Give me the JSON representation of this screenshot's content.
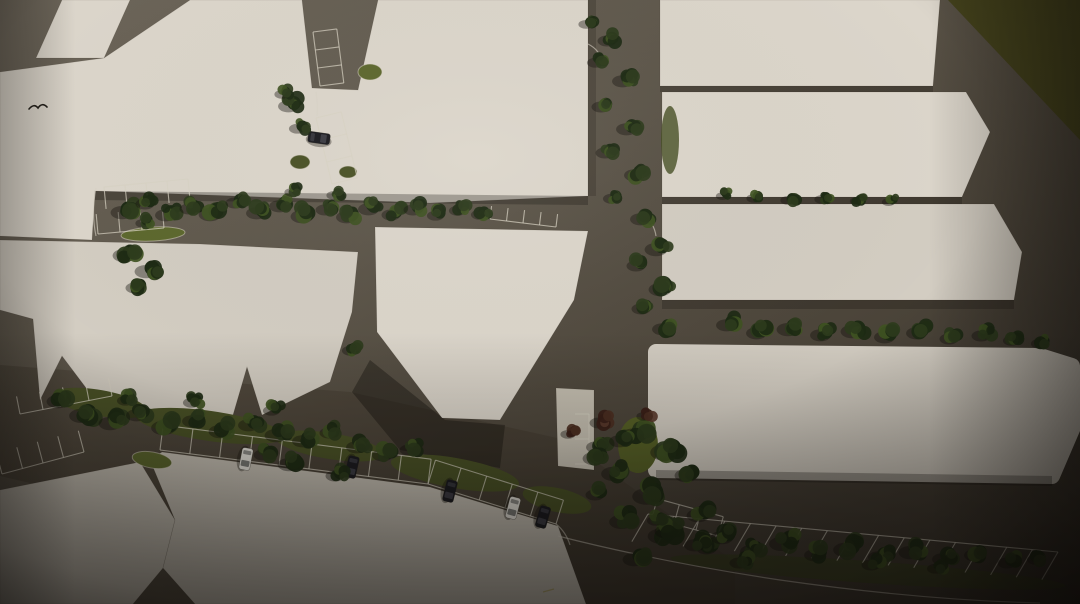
{
  "scene": {
    "description": "Aerial top-down architectural site-plan rendering: cream building blocks separated by dark asphalt roads, street trees, striped parking bays, a few parked cars, olive grass corner at top right, photographic vignette",
    "canvas": {
      "width": 1080,
      "height": 604
    },
    "palette": {
      "road_light": "#6e675b",
      "road_mid": "#5a5348",
      "road_dark": "#3b3429",
      "building_light": "#dcd6cb",
      "building_mid": "#d3cdc2",
      "building_dim": "#c9c3b7",
      "pavement": "#c6c0b2",
      "grass_corner": "#45431c",
      "grass_strip": "#4a5226",
      "grass_bright": "#5d682e",
      "tree_dark": "#1d2a14",
      "tree_mid": "#2c3b1c",
      "tree_light": "#3f5322",
      "tree_red": "#4c2f22",
      "line_white": "#d8d2c4",
      "line_yellow": "#a89a48",
      "car_white": "#e5e2da",
      "car_dark": "#1b1b20",
      "shadow": "#15110c"
    },
    "grass_areas": [
      {
        "id": "top-right-lawn",
        "points": "948,0 1080,0 1080,140",
        "fill": "grass_corner"
      }
    ],
    "road_shade": {
      "points": "0,365 350,392 566,440 735,562 735,604 556,604 0,476",
      "fill": "road_dark",
      "op": 0.35
    },
    "buildings": [
      {
        "id": "top-left-tab",
        "tone": "building_light",
        "points": "62,0 130,0 104,58 36,58"
      },
      {
        "id": "top-band-block",
        "tone": "building_light",
        "points": "190,0 302,0 312,88 358,90 378,0 588,0 588,196 430,203 95,191 92,240 0,236 0,72 104,58"
      },
      {
        "id": "mid-left-row",
        "tone": "building_mid",
        "points": "0,240 200,244 358,252 352,312 330,382 262,415 247,367 233,415 108,417 62,356 40,400 33,319 0,310"
      },
      {
        "id": "center-block",
        "tone": "building_light",
        "points": "375,227 588,231 574,300 500,420 442,418 377,332"
      },
      {
        "id": "bottom-left-slab",
        "tone": "building_dim",
        "points": "0,490 60,478 140,462 175,520 163,568 133,604 0,604"
      },
      {
        "id": "bottom-center-slab",
        "tone": "building_dim",
        "points": "162,452 430,487 558,526 586,604 195,604 163,568 175,520 150,460"
      },
      {
        "id": "parking-apron",
        "tone": "pavement",
        "points": "556,388 594,390 594,470 558,466"
      },
      {
        "id": "top-right-bar-1",
        "tone": "building_light",
        "points": "660,0 940,0 933,86 660,86"
      },
      {
        "id": "top-right-bar-2",
        "tone": "building_light",
        "points": "662,92 966,92 990,132 962,197 662,197"
      },
      {
        "id": "top-right-bar-3",
        "tone": "building_mid",
        "points": "662,204 994,204 1022,252 1014,300 662,300"
      },
      {
        "id": "right-long-bar",
        "tone": "building_mid",
        "points": "656,352 1040,356 1072,366 1076,420 1052,476 656,470",
        "rounded": true
      }
    ],
    "building_shadows": [
      {
        "points": "95,191 588,196 588,205 95,200",
        "op": 0.3
      },
      {
        "points": "370,360 445,420 505,425 500,468 400,450 352,392",
        "op": 0.4
      },
      {
        "points": "656,470 1052,476 1052,486 656,480",
        "op": 0.3
      },
      {
        "points": "662,300 1014,300 1014,309 662,309",
        "op": 0.25
      },
      {
        "points": "662,197 962,197 962,204 662,204",
        "op": 0.25
      },
      {
        "points": "660,86 933,86 933,92 660,92",
        "op": 0.25
      },
      {
        "points": "588,0 596,0 596,196 588,196",
        "op": 0.2
      }
    ],
    "grass_islands": [
      {
        "cx": 152,
        "cy": 460,
        "rx": 20,
        "ry": 8,
        "rot": 10,
        "fill": "grass_bright",
        "stroke": true
      },
      {
        "cx": 153,
        "cy": 234,
        "rx": 32,
        "ry": 7,
        "rot": -3,
        "fill": "grass_bright",
        "stroke": true
      },
      {
        "cx": 370,
        "cy": 72,
        "rx": 12,
        "ry": 8,
        "rot": 0,
        "fill": "grass_bright",
        "stroke": true
      },
      {
        "cx": 300,
        "cy": 162,
        "rx": 10,
        "ry": 7,
        "rot": 0,
        "fill": "grass_strip",
        "stroke": true
      },
      {
        "cx": 348,
        "cy": 172,
        "rx": 9,
        "ry": 6,
        "rot": 0,
        "fill": "grass_strip",
        "stroke": true
      },
      {
        "cx": 638,
        "cy": 445,
        "rx": 20,
        "ry": 28,
        "rot": 0,
        "fill": "#566026",
        "stroke": false
      },
      {
        "cx": 868,
        "cy": 572,
        "rx": 198,
        "ry": 11,
        "rot": 4,
        "fill": "#39411e",
        "stroke": false,
        "op": 0.7
      },
      {
        "cx": 670,
        "cy": 140,
        "rx": 9,
        "ry": 34,
        "rot": 0,
        "fill": "#454d22",
        "stroke": false,
        "op": 0.8
      },
      {
        "cx": 100,
        "cy": 403,
        "rx": 48,
        "ry": 13,
        "rot": 10,
        "fill": "grass_strip",
        "stroke": false
      },
      {
        "cx": 210,
        "cy": 426,
        "rx": 75,
        "ry": 15,
        "rot": 8,
        "fill": "grass_strip",
        "stroke": false
      },
      {
        "cx": 330,
        "cy": 446,
        "rx": 55,
        "ry": 13,
        "rot": 9,
        "fill": "grass_strip",
        "stroke": false
      },
      {
        "cx": 455,
        "cy": 473,
        "rx": 65,
        "ry": 15,
        "rot": 10,
        "fill": "grass_strip",
        "stroke": false
      },
      {
        "cx": 557,
        "cy": 500,
        "rx": 35,
        "ry": 12,
        "rot": 12,
        "fill": "grass_strip",
        "stroke": false
      }
    ],
    "parking_rows": [
      {
        "id": "north-road-bays-upper",
        "x1": 313,
        "y1": 32,
        "x2": 320,
        "y2": 86,
        "n": 3,
        "depth": 24,
        "tick_rot": -90,
        "outer": true
      },
      {
        "id": "north-road-bays-lower",
        "x1": 316,
        "y1": 118,
        "x2": 332,
        "y2": 184,
        "n": 3,
        "depth": 26,
        "tick_rot": -90,
        "outer": true
      },
      {
        "id": "upper-road-west-stalls-a",
        "x1": 104,
        "y1": 187,
        "x2": 188,
        "y2": 179,
        "n": 4,
        "depth": 22,
        "tick_rot": 90
      },
      {
        "id": "upper-road-west-stalls-b",
        "x1": 98,
        "y1": 234,
        "x2": 164,
        "y2": 228,
        "n": 3,
        "depth": 20,
        "tick_rot": -90
      },
      {
        "id": "west-edge-stalls-a",
        "x1": 20,
        "y1": 414,
        "x2": 112,
        "y2": 396,
        "n": 4,
        "depth": 18,
        "tick_rot": -90
      },
      {
        "id": "west-edge-stalls-b",
        "x1": 2,
        "y1": 474,
        "x2": 84,
        "y2": 452,
        "n": 4,
        "depth": 22,
        "tick_rot": -90
      },
      {
        "id": "central-diagonal-row-a",
        "x1": 160,
        "y1": 450,
        "x2": 428,
        "y2": 484,
        "n": 9,
        "depth": 25,
        "tick_rot": -90,
        "outer": true
      },
      {
        "id": "central-diagonal-row-b",
        "x1": 428,
        "y1": 484,
        "x2": 556,
        "y2": 524,
        "n": 5,
        "depth": 25,
        "tick_rot": -90,
        "outer": true
      },
      {
        "id": "center-road-stalls",
        "x1": 490,
        "y1": 219,
        "x2": 556,
        "y2": 227,
        "n": 4,
        "depth": 13,
        "tick_rot": -90
      },
      {
        "id": "south-center-bay-outline",
        "x1": 652,
        "y1": 518,
        "x2": 718,
        "y2": 536,
        "n": 3,
        "depth": 20,
        "tick_rot": -90,
        "outer": true
      },
      {
        "id": "southeast-long-row",
        "x1": 648,
        "y1": 514,
        "x2": 1058,
        "y2": 552,
        "n": 16,
        "depth": 32,
        "tick_rot": 90,
        "skew": 25
      },
      {
        "id": "apron-stalls",
        "x1": 589,
        "y1": 414,
        "x2": 589,
        "y2": 464,
        "n": 2,
        "depth": 14,
        "tick_rot": 90
      }
    ],
    "road_markings": [
      {
        "d": "M588 44 Q600 50 602 62"
      },
      {
        "d": "M643 216 Q654 222 656 236"
      },
      {
        "d": "M558 536 Q660 562 780 580 Q920 600 1040 603"
      },
      {
        "d": "M556 524 Q566 532 570 545"
      },
      {
        "d": "M96 188 Q91 212 96 236"
      },
      {
        "d": "M316 92 Q318 104 317 116",
        "op": 0.4
      },
      {
        "d": "M543 592 L554 589",
        "color": "line_yellow"
      }
    ],
    "tree_clusters": [
      [
        128,
        209,
        12
      ],
      [
        150,
        201,
        10
      ],
      [
        171,
        212,
        11
      ],
      [
        194,
        206,
        10
      ],
      [
        147,
        221,
        8
      ],
      [
        216,
        211,
        12
      ],
      [
        240,
        200,
        10
      ],
      [
        262,
        210,
        11
      ],
      [
        285,
        203,
        11
      ],
      [
        308,
        213,
        12
      ],
      [
        330,
        207,
        10
      ],
      [
        352,
        214,
        11
      ],
      [
        374,
        206,
        11
      ],
      [
        396,
        212,
        10
      ],
      [
        418,
        207,
        10
      ],
      [
        440,
        213,
        9
      ],
      [
        462,
        208,
        9
      ],
      [
        484,
        212,
        9
      ],
      [
        296,
        190,
        8
      ],
      [
        338,
        193,
        8
      ],
      [
        130,
        252,
        12
      ],
      [
        152,
        268,
        12
      ],
      [
        140,
        285,
        10
      ],
      [
        294,
        103,
        11
      ],
      [
        302,
        126,
        9
      ],
      [
        286,
        92,
        8
      ],
      [
        590,
        22,
        8
      ],
      [
        612,
        38,
        10
      ],
      [
        600,
        60,
        9
      ],
      [
        628,
        78,
        11
      ],
      [
        606,
        104,
        10
      ],
      [
        632,
        126,
        11
      ],
      [
        610,
        150,
        10
      ],
      [
        640,
        172,
        11
      ],
      [
        616,
        196,
        9
      ],
      [
        646,
        216,
        11
      ],
      [
        662,
        246,
        12
      ],
      [
        641,
        263,
        10
      ],
      [
        666,
        286,
        12
      ],
      [
        646,
        306,
        10
      ],
      [
        668,
        326,
        11
      ],
      [
        355,
        348,
        9
      ],
      [
        726,
        194,
        7
      ],
      [
        758,
        196,
        8
      ],
      [
        792,
        198,
        8
      ],
      [
        826,
        197,
        8
      ],
      [
        860,
        199,
        7
      ],
      [
        892,
        200,
        7
      ],
      [
        732,
        322,
        11
      ],
      [
        762,
        330,
        11
      ],
      [
        794,
        326,
        12
      ],
      [
        826,
        332,
        11
      ],
      [
        858,
        328,
        12
      ],
      [
        890,
        334,
        11
      ],
      [
        922,
        330,
        11
      ],
      [
        954,
        336,
        10
      ],
      [
        986,
        333,
        10
      ],
      [
        1016,
        338,
        9
      ],
      [
        1044,
        341,
        9
      ],
      [
        64,
        398,
        12
      ],
      [
        88,
        412,
        13
      ],
      [
        116,
        420,
        12
      ],
      [
        142,
        412,
        11
      ],
      [
        170,
        424,
        13
      ],
      [
        198,
        418,
        11
      ],
      [
        226,
        428,
        12
      ],
      [
        254,
        422,
        11
      ],
      [
        282,
        432,
        12
      ],
      [
        308,
        438,
        11
      ],
      [
        334,
        430,
        10
      ],
      [
        276,
        408,
        9
      ],
      [
        196,
        400,
        9
      ],
      [
        130,
        398,
        9
      ],
      [
        268,
        452,
        10
      ],
      [
        295,
        461,
        12
      ],
      [
        340,
        473,
        10
      ],
      [
        362,
        444,
        11
      ],
      [
        388,
        452,
        11
      ],
      [
        414,
        447,
        10
      ],
      [
        640,
        432,
        14
      ],
      [
        672,
        448,
        15
      ],
      [
        620,
        470,
        13
      ],
      [
        654,
        492,
        15
      ],
      [
        692,
        472,
        12
      ],
      [
        628,
        518,
        13
      ],
      [
        668,
        532,
        14
      ],
      [
        704,
        512,
        12
      ],
      [
        640,
        556,
        12
      ],
      [
        602,
        444,
        11
      ],
      [
        600,
        492,
        10
      ],
      [
        712,
        545,
        11
      ],
      [
        600,
        455,
        12
      ],
      [
        625,
        438,
        11
      ],
      [
        672,
        528,
        12
      ],
      [
        700,
        542,
        11
      ],
      [
        728,
        534,
        12
      ],
      [
        756,
        548,
        11
      ],
      [
        788,
        540,
        13
      ],
      [
        820,
        552,
        11
      ],
      [
        852,
        546,
        13
      ],
      [
        884,
        554,
        11
      ],
      [
        916,
        549,
        12
      ],
      [
        948,
        556,
        11
      ],
      [
        980,
        552,
        11
      ],
      [
        1012,
        560,
        10
      ],
      [
        1040,
        557,
        9
      ],
      [
        660,
        518,
        9
      ],
      [
        744,
        560,
        10
      ],
      [
        876,
        562,
        10
      ],
      [
        940,
        566,
        9
      ]
    ],
    "red_trees": [
      [
        604,
        420,
        10
      ],
      [
        572,
        432,
        8
      ],
      [
        648,
        414,
        8
      ]
    ],
    "cars": [
      {
        "x": 246,
        "y": 459,
        "angle": 101,
        "color": "white"
      },
      {
        "x": 352,
        "y": 467,
        "angle": 103,
        "color": "dark"
      },
      {
        "x": 450,
        "y": 491,
        "angle": 104,
        "color": "dark"
      },
      {
        "x": 513,
        "y": 508,
        "angle": 105,
        "color": "white"
      },
      {
        "x": 543,
        "y": 517,
        "angle": 106,
        "color": "dark"
      },
      {
        "x": 319,
        "y": 138,
        "angle": 8,
        "color": "dark"
      }
    ],
    "bird": {
      "x": 37,
      "y": 107
    }
  }
}
